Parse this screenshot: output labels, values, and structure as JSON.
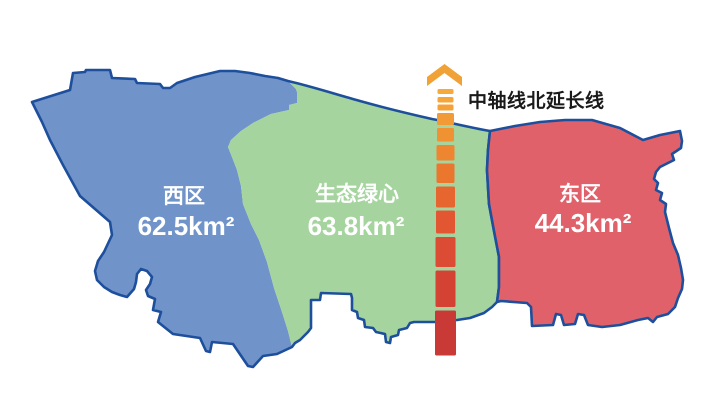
{
  "page": {
    "background": "#FFFFFF"
  },
  "map": {
    "outline_color": "#1D4F9C",
    "label_color": "#FFFFFF",
    "regions": {
      "west": {
        "name": "西区",
        "area": "62.5km²",
        "color": "#7094C9"
      },
      "center": {
        "name": "生态绿心",
        "area": "63.8km²",
        "color": "#A5D49E"
      },
      "east": {
        "name": "东区",
        "area": "44.3km²",
        "color": "#E0616A"
      }
    }
  },
  "axis": {
    "label": "中轴线北延长线",
    "label_color": "#1A1A1A",
    "arrow_color": "#F0A236",
    "dash_colors": [
      "#F6A93C",
      "#F5A63A",
      "#F4A238",
      "#F29A35",
      "#F09132",
      "#EE8530",
      "#EB762E",
      "#E7662F",
      "#E25731",
      "#DC4B33",
      "#D44234",
      "#C93A37"
    ]
  }
}
